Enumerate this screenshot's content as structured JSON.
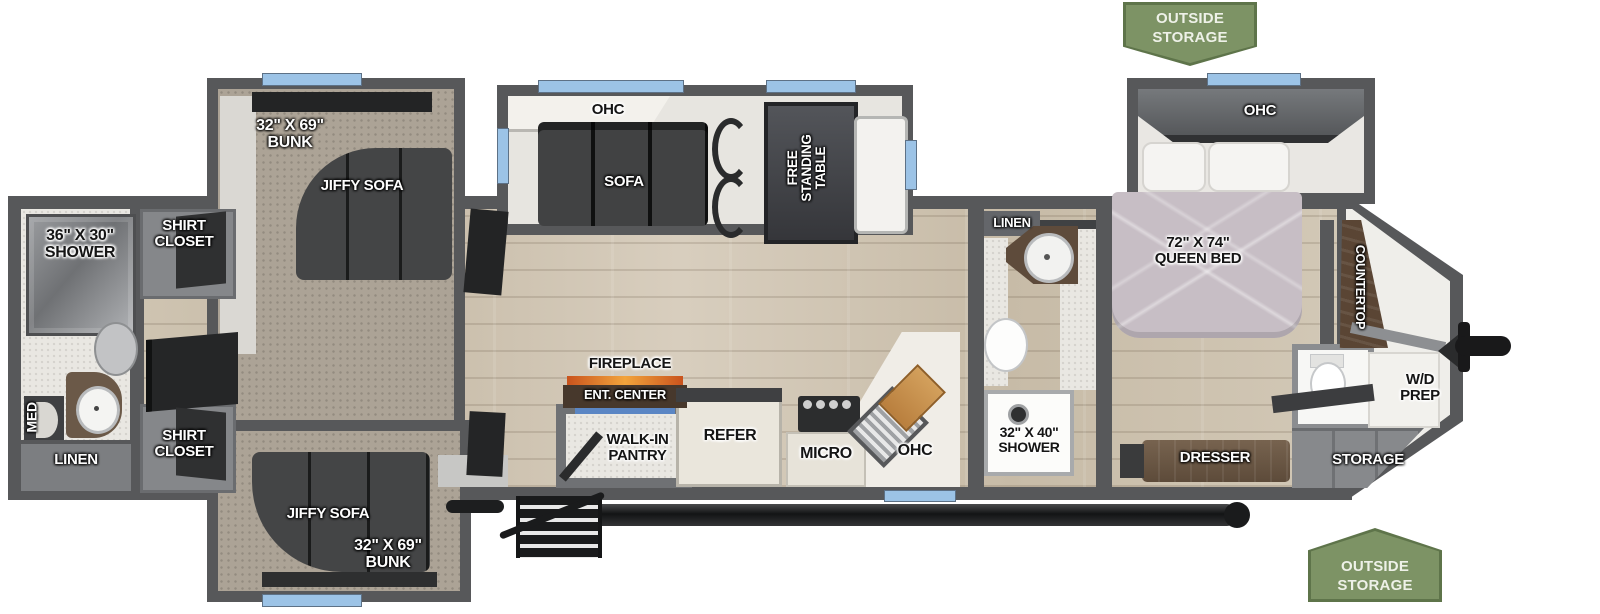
{
  "banners": {
    "top": "OUTSIDE\nSTORAGE",
    "bottom": "OUTSIDE\nSTORAGE"
  },
  "labels": {
    "rear_shower": "36\" X 30\"\nSHOWER",
    "med": "MED",
    "rear_linen": "LINEN",
    "shirt_closet_top": "SHIRT\nCLOSET",
    "shirt_closet_bottom": "SHIRT\nCLOSET",
    "bunk_top": "32\" X 69\"\nBUNK",
    "jiffy_sofa_top": "JIFFY SOFA",
    "bunk_bottom": "32\" X 69\"\nBUNK",
    "jiffy_sofa_bottom": "JIFFY SOFA",
    "ohc_living": "OHC",
    "sofa": "SOFA",
    "free_standing_table": "FREE\nSTANDING\nTABLE",
    "fireplace": "FIREPLACE",
    "ent_center": "ENT. CENTER",
    "walk_in_pantry": "WALK-IN\nPANTRY",
    "refer": "REFER",
    "micro": "MICRO",
    "ohc_kitchen": "OHC",
    "mid_linen": "LINEN",
    "mid_shower": "32\" X 40\"\nSHOWER",
    "ohc_bedroom": "OHC",
    "queen_bed": "72\" X 74\"\nQUEEN BED",
    "countertop": "COUNTERTOP",
    "wd_prep": "W/D\nPREP",
    "dresser": "DRESSER",
    "storage": "STORAGE"
  },
  "colors": {
    "wall": "#57585a",
    "slide_wall": "#8e9093",
    "window_blue": "#9cc3e6",
    "banner_green": "#7d9365",
    "wood_floor": "#cdc3b1",
    "carpet": "#aca396",
    "dark_furniture": "#3a3b3c",
    "wood_furniture": "#6b5948",
    "bedspread_mauve": "#c7bec5"
  }
}
